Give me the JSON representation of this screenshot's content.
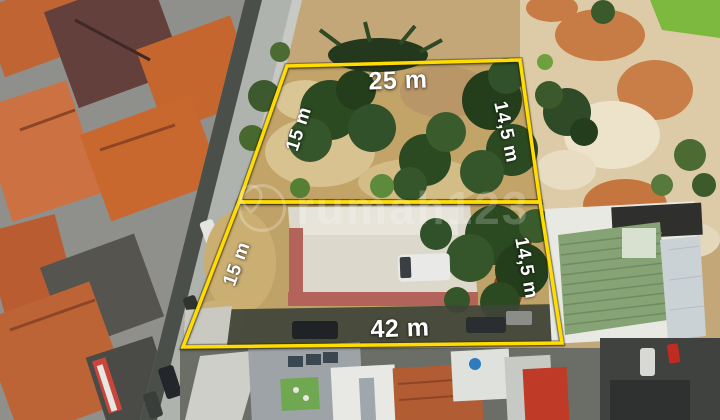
{
  "annotations": {
    "back_plot": {
      "top": "25 m",
      "left": "15 m",
      "right": "14,5 m"
    },
    "front_plot": {
      "left": "15 m",
      "right": "14,5 m",
      "front": "42 m"
    }
  },
  "watermark": {
    "text": "rumah123"
  },
  "colors": {
    "boundary": "#FFDD00",
    "label": "#FFFFFF"
  }
}
